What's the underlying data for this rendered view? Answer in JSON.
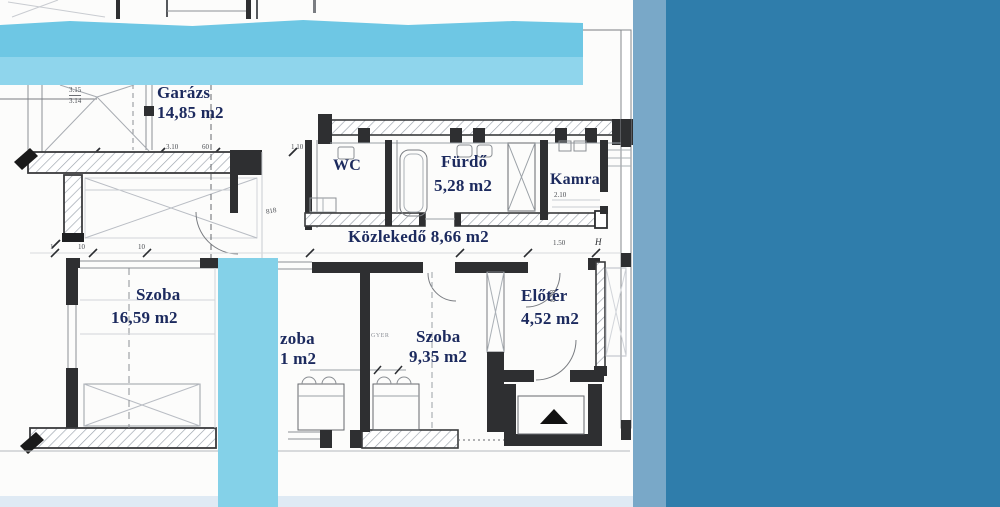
{
  "rooms": {
    "garage": {
      "label": "Garázs",
      "area": "14,85 m2"
    },
    "wc": {
      "label": "WC"
    },
    "bathroom": {
      "label": "Fürdő",
      "area": "5,28 m2"
    },
    "pantry": {
      "label": "Kamra"
    },
    "hallway": {
      "label": "Közlekedő",
      "area": "8,66 m2"
    },
    "room_left": {
      "label": "Szoba",
      "area": "16,59 m2"
    },
    "room_middle": {
      "label_fragment": "zoba",
      "area_fragment": "1 m2"
    },
    "room_right": {
      "label": "Szoba",
      "area": "9,35 m2",
      "annotation": "GYER"
    },
    "foyer": {
      "label": "Előtér",
      "area": "4,52 m2"
    }
  },
  "dimensions": {
    "garage_width_a": "3.15",
    "garage_width_b": "3.14",
    "garage_dim_a": "3.10",
    "garage_dim_b": "60",
    "garage_dim_c": "1.10",
    "wall_tick_a": "1",
    "wall_tick_b": "10",
    "wall_tick_c": "10",
    "door_code": "818",
    "pantry_depth": "2.10",
    "foyer_opening": "1.50",
    "section_marker": "H",
    "foyer_door": "8,78"
  },
  "colors": {
    "highlight_top": "#6ec7e4",
    "highlight_top_light": "#8fd5ec",
    "highlight_bar": "#84d1e8",
    "side_strip": "#79a8c8",
    "side_band": "#2f7dab",
    "bottom_strip": "#dfeaf4",
    "label_ink": "#1c2a5e",
    "wall_ink": "#2e2f31"
  }
}
